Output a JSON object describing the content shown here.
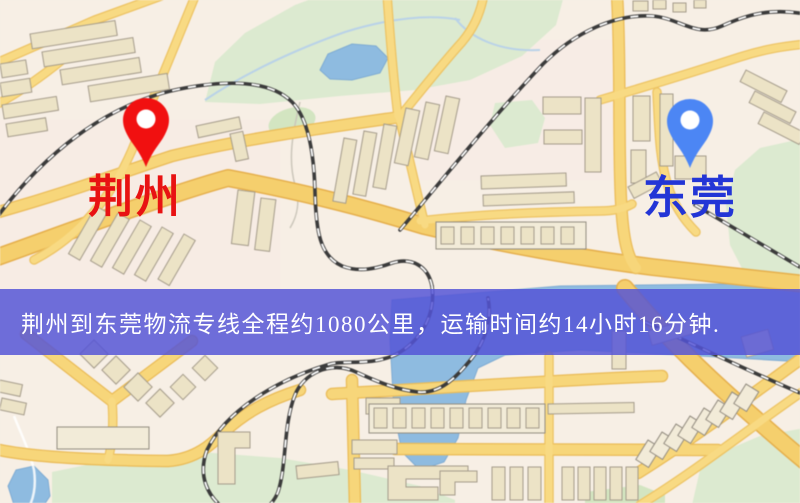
{
  "banner": {
    "text": "荆州到东莞物流专线全程约1080公里，运输时间约14小时16分钟.",
    "background_color": "#5353d7",
    "text_color": "#ffffff"
  },
  "pins": {
    "origin": {
      "label": "荆州",
      "pin_color": "#ee1111",
      "label_color": "#e81212"
    },
    "destination": {
      "label": "东莞",
      "pin_color": "#4d86f2",
      "label_color": "#2335d6"
    }
  },
  "map_palette": {
    "background": "#f7efe5",
    "road_fill": "#f6d67c",
    "road_casing": "#e9bb59",
    "building": "#ece3c7",
    "building_light": "#f2ebd8",
    "park": "#dcead0",
    "water": "#8fbbdf",
    "railway": "#3b3b3b"
  }
}
